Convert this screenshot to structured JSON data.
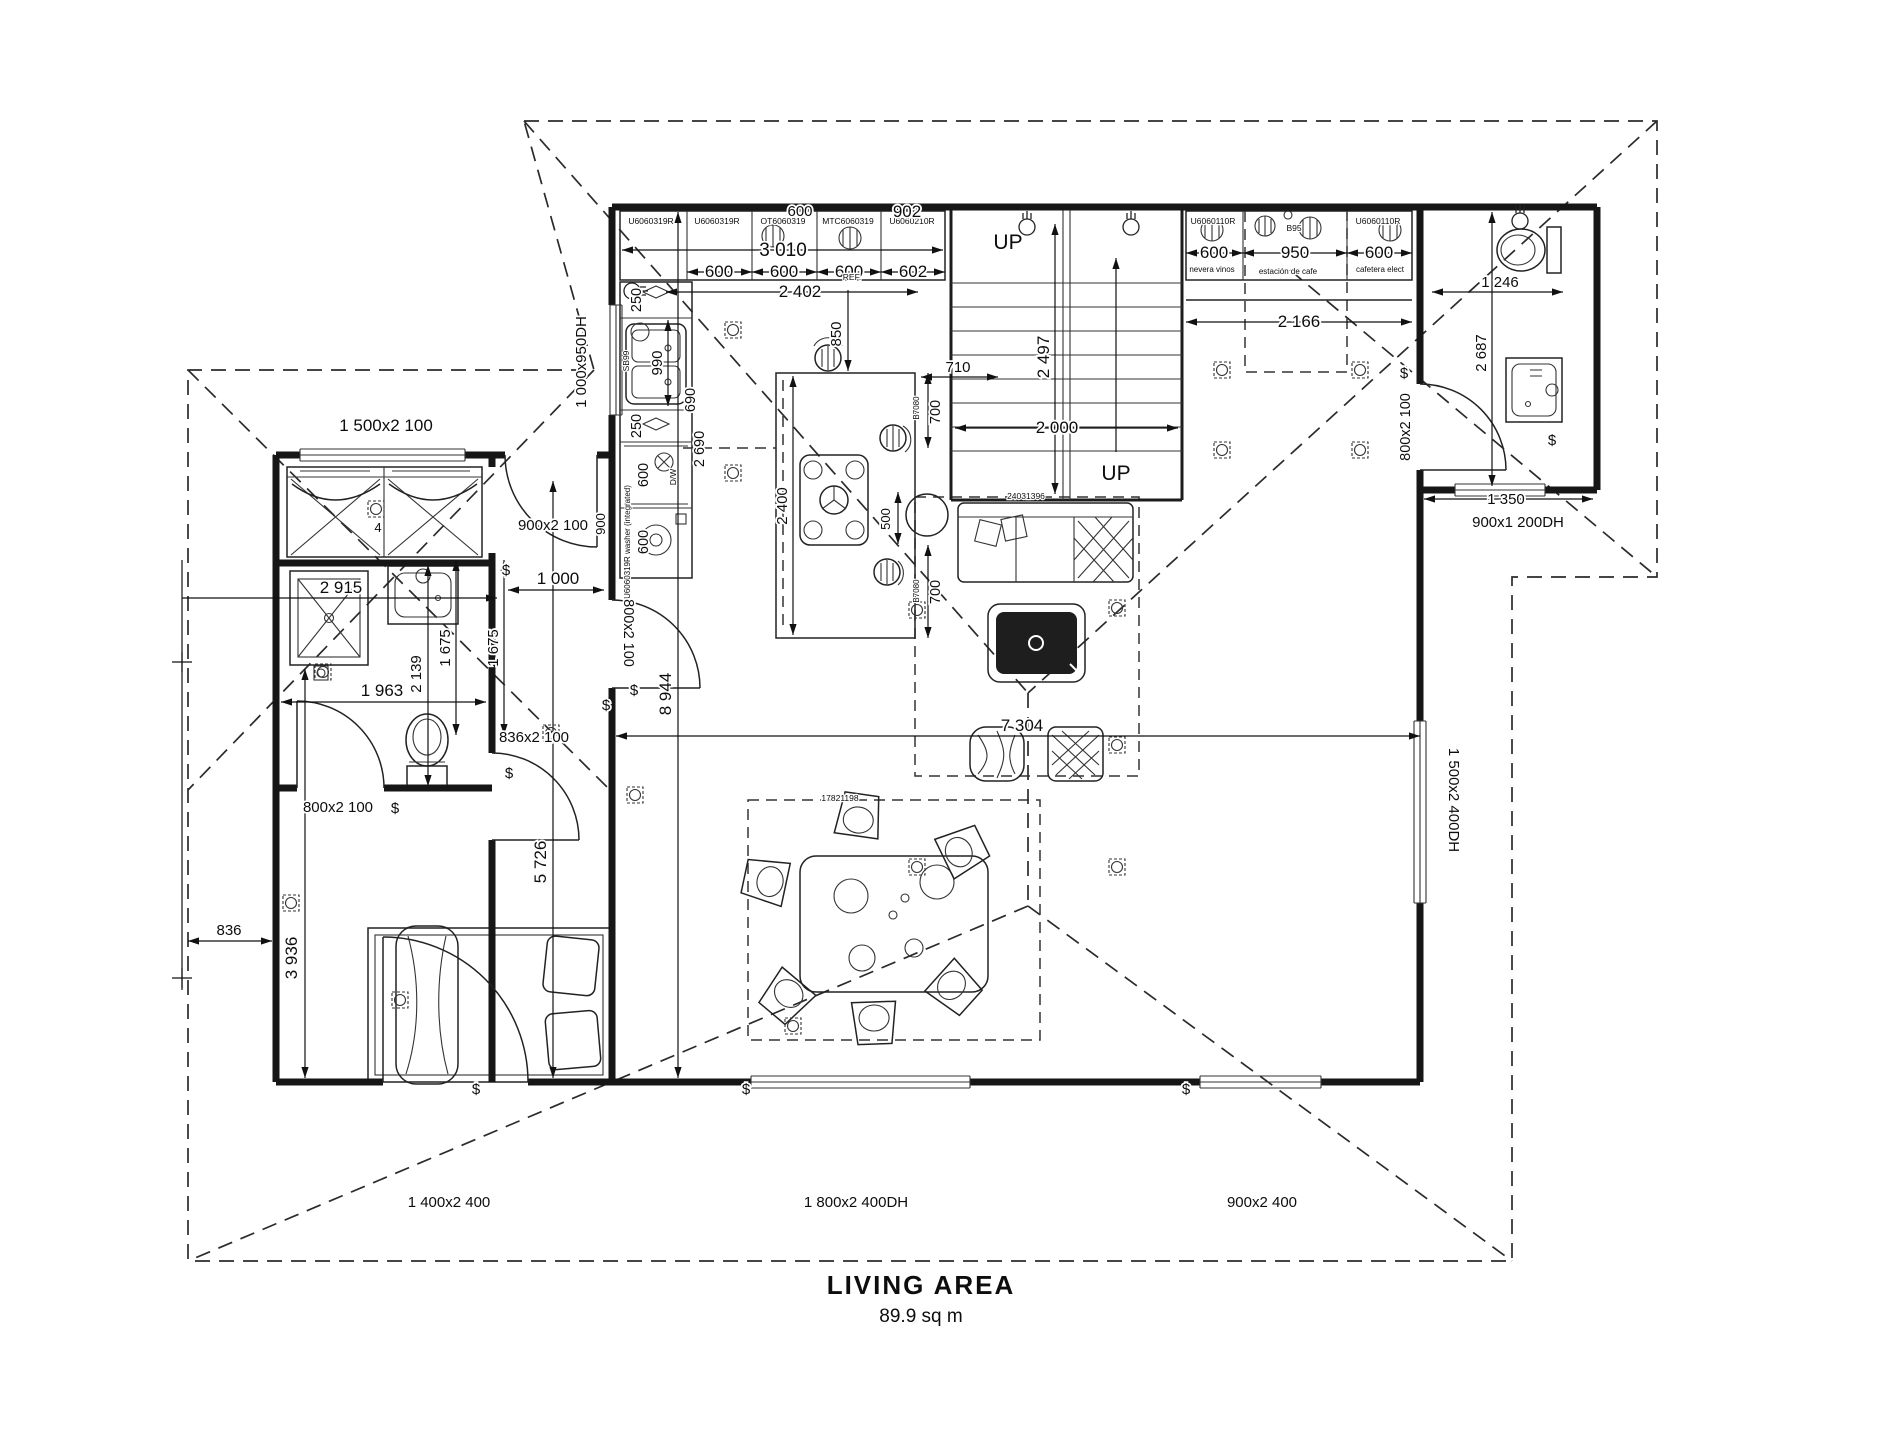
{
  "title": {
    "name": "LIVING AREA",
    "area": "89.9 sq m"
  },
  "stairs": {
    "up1": "UP",
    "up2": "UP",
    "width": "2 000",
    "height": "2 497"
  },
  "kitchen": {
    "cabinets": [
      "U6060319R",
      "U6060319R",
      "OT6060319",
      "MTC6060319",
      "U6060210R"
    ],
    "d600top": "600",
    "d902": "902",
    "d3010": "3 010",
    "d600a": "600",
    "d600b": "600",
    "d600c": "600",
    "d602": "602",
    "d2402": "2 402",
    "ref": "REF.",
    "window": "1 000x950DH",
    "d250a": "250",
    "sink": "SB99",
    "d990": "990",
    "d690": "690",
    "d2690": "2 690",
    "d250b": "250",
    "d600dw": "600",
    "dw": "D/W",
    "d600w": "600",
    "washer": "U6060319R washer (integrated)",
    "d900": "900",
    "island_code_a": "B7080",
    "island_code_b": "B7080",
    "d700a": "700",
    "d700b": "700",
    "d710": "710",
    "d850": "850",
    "d500": "500",
    "d2400": "2 400"
  },
  "coffee": {
    "code1": "U6060110R",
    "code2": "B95",
    "code3": "U6060110R",
    "d600a": "600",
    "d950": "950",
    "d600b": "600",
    "note1": "nevera vinos",
    "note2": "estación de cafe",
    "note3": "cafetera elect",
    "d2166": "2 166"
  },
  "bath": {
    "d1246": "1 246",
    "d2687": "2 687",
    "d1350": "1 350",
    "door": "800x2 100",
    "window": "900x1 200DH"
  },
  "living": {
    "sofa": "24031396",
    "window": "1 500x2 400DH",
    "d7304": "7 304",
    "d8944": "8 944"
  },
  "dining": {
    "code": "17821198"
  },
  "hall": {
    "door_top": "900x2 100",
    "d1000": "1 000",
    "door_living": "800x2 100",
    "door_bed": "836x2 100",
    "d5726": "5 726"
  },
  "bedroom": {
    "window": "1 500x2 100",
    "wardrobe": "4",
    "d2915": "2 915",
    "d1963": "1 963",
    "d2139": "2 139",
    "d1675a": "1 675",
    "d1675b": "1 675",
    "door_ensuite": "800x2 100",
    "d836": "836",
    "d3936": "3 936",
    "door_front": "1 400x2 400"
  },
  "bottom": {
    "w1": "1 800x2 400DH",
    "w2": "900x2 400"
  },
  "sym": {
    "sw": "$"
  }
}
